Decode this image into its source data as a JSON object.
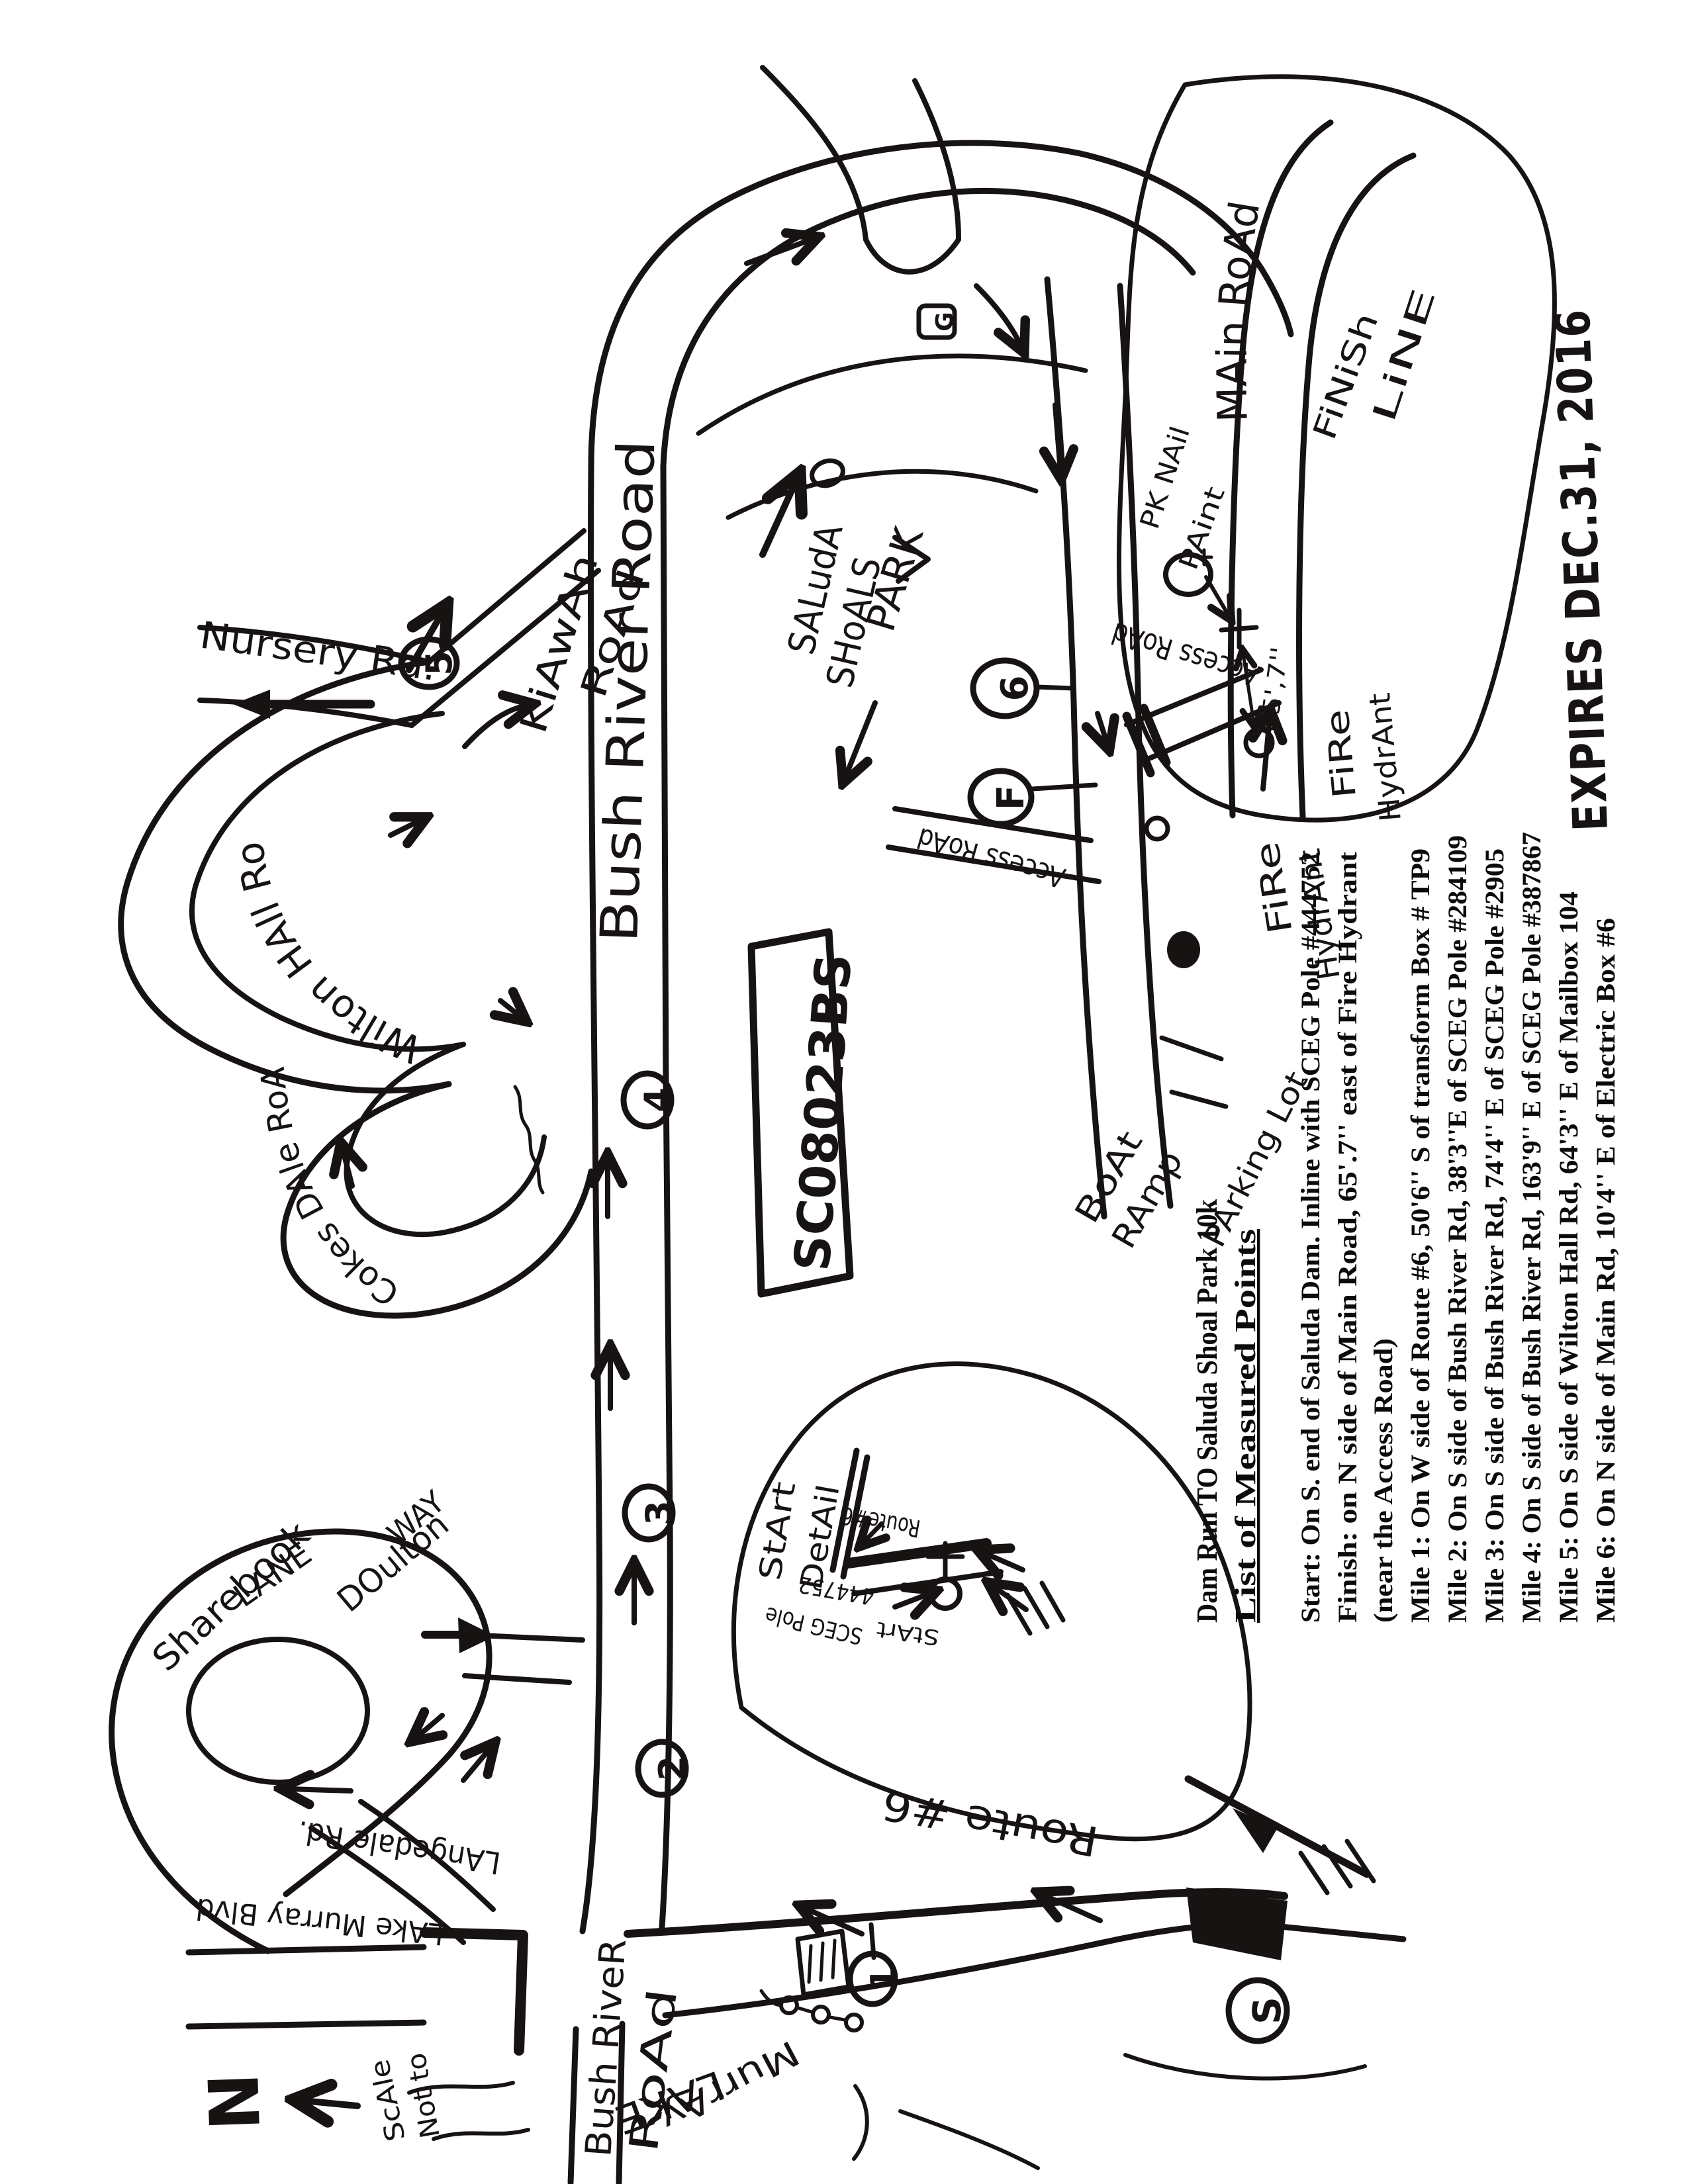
{
  "certification": {
    "course_code": "SC08023BS",
    "expiration_note": "EXPIRES DEC.31, 2016"
  },
  "measured_points": {
    "title": "Dam Run TO Saluda Shoal Park 10k",
    "heading": "List of Measured Points",
    "entries": [
      "Start: On S. end of Saluda Dam. Inline with SCEG Pole #444752",
      "Finish: on N side of Main Road, 65'.7'' east of Fire Hydrant",
      "(near the Access Road)",
      "Mile 1: On W side of Route #6, 50'6'' S of transform Box # TP9",
      "Mile 2: On S side of Bush River Rd, 38'3''E of SCEG Pole #284109",
      "Mile 3: On S side of Bush River Rd, 74'4'' E of SCEG Pole #2905",
      "Mile 4: On S side of Bush River Rd, 163'9'' E of SCEG Pole #387867",
      "Mile 5: On S side of Wilton Hall Rd, 64'3'' E of Mailbox 104",
      "Mile 6: On N side of Main Rd, 10'4'' E of Electric Box #6"
    ]
  },
  "roads": {
    "bush_river_road": "Bush River Road",
    "bush_river": "Bush RiveR",
    "road_word": "RoAd",
    "nursery": "Nursery Rd.",
    "kiawah": "KiAwAh",
    "kiawah_road": "RoAd",
    "wilton_hall": "Wilton HAll RoAd",
    "cokes_dale": "Cokes DAle RoAd",
    "sharebook": "Sharebook",
    "lane": "LANE",
    "doulton": "DOulton",
    "way": "WAY",
    "langedale": "LAngedale Rd.",
    "lake_murray_blvd": "LAke Murray Blvd.",
    "route6": "Route #6",
    "route6_detail": "Route#6",
    "main_road": "MAin RoAd",
    "access_road": "Access RoAd"
  },
  "places": {
    "park_line1": "SALudA",
    "park_line2": "SHoALS",
    "park_line3": "PARK",
    "lake_line1": "LAKE",
    "lake_line2": "MurrAy",
    "parking_lot": "PArking Lot",
    "boat_ramp_1": "BoAt",
    "boat_ramp_2": "RAmp",
    "fire": "FiRe",
    "hydrant": "HydrAnt"
  },
  "start_detail": {
    "title_1": "StArt",
    "title_2": "DetAil",
    "pole_1": "SCEG Pole",
    "pole_2": "444752",
    "start_label": "StArt"
  },
  "finish_detail": {
    "pk_nail": "PK NAil",
    "paint": "PAint",
    "finish_word": "FiNiSh",
    "line_word": "LiNE",
    "measurement": "65',7''"
  },
  "markers": {
    "mile1": "1",
    "mile2": "2",
    "mile3": "3",
    "mile4": "4",
    "mile5": "5",
    "mile6": "6",
    "finish": "F",
    "start": "S",
    "gate": "G"
  },
  "compass": {
    "north": "N",
    "note_1": "Not to",
    "note_2": "ScAle"
  }
}
